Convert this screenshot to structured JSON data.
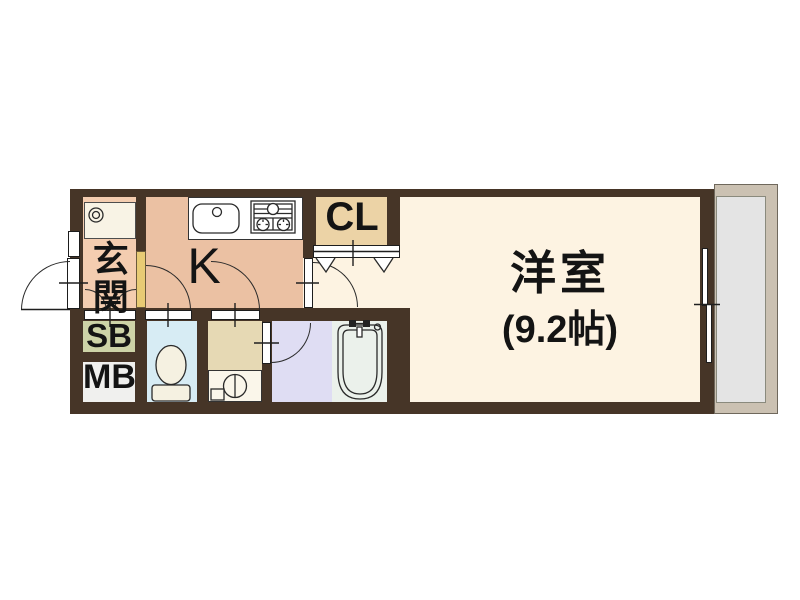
{
  "title": "apartment-floor-plan",
  "rooms": {
    "genkan": {
      "label": "玄関",
      "color": "#f4cdb0"
    },
    "kitchen": {
      "label": "K",
      "color": "#ebc1a3"
    },
    "closet": {
      "label": "CL",
      "color": "#ecd3a6"
    },
    "hall": {
      "color": "#fdf3e2"
    },
    "western_room": {
      "label": "洋室",
      "size_label": "(9.2帖)",
      "color": "#fdf3e2"
    },
    "shoe_box": {
      "label": "SB",
      "color": "#cdd3a7"
    },
    "meter_box": {
      "label": "MB",
      "color": "#f0f0ee"
    },
    "toilet": {
      "color": "#d7ecf4"
    },
    "washroom": {
      "color": "#e6d9b4"
    },
    "washroom_counter": {
      "color": "#faf6ea"
    },
    "bathroom": {
      "color": "#dfddf3"
    },
    "bathtub_area": {
      "color": "#ebf1eb"
    },
    "laundry_pan": {
      "color": "#f8f3e5"
    }
  },
  "structure": {
    "wall_color": "#463527",
    "step_color": "#e8cb74",
    "balcony_frame_color": "#cbc1b2",
    "balcony_floor_color": "#e4e4e4",
    "line_color": "#1f1f1f",
    "background_color": "#ffffff"
  }
}
